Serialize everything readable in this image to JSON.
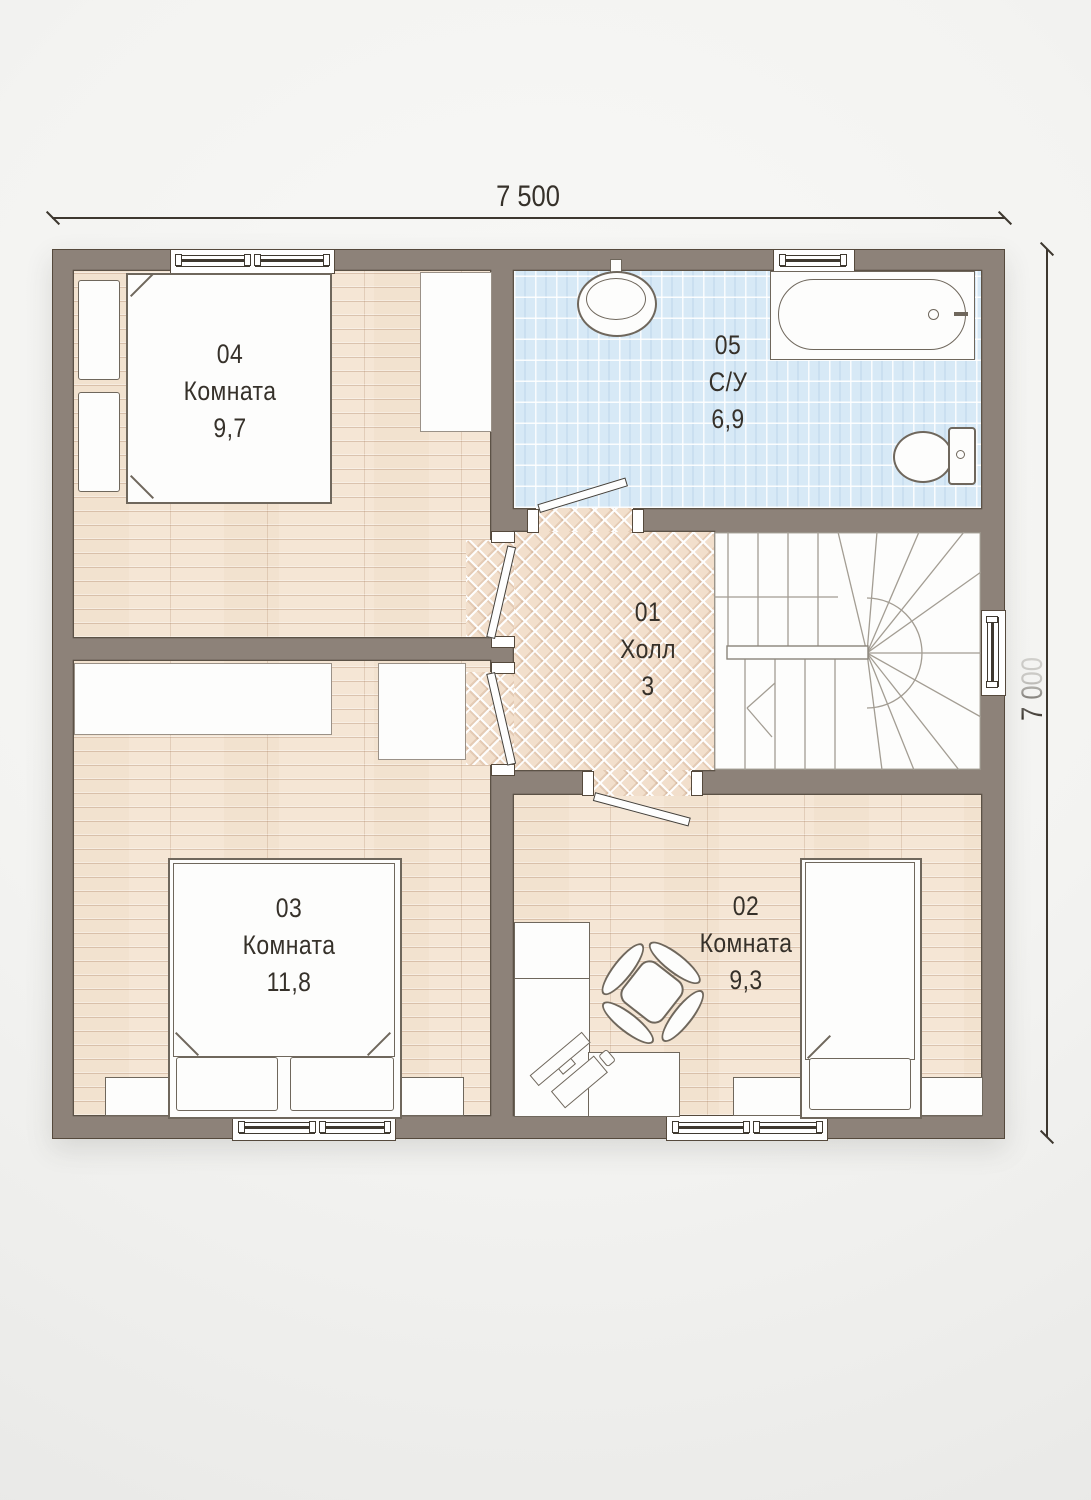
{
  "dimensions": {
    "width_label": "7 500",
    "height_label": "7 000"
  },
  "rooms": {
    "hall": {
      "number": "01",
      "name": "Холл",
      "area": "3"
    },
    "room2": {
      "number": "02",
      "name": "Комната",
      "area": "9,3"
    },
    "room3": {
      "number": "03",
      "name": "Комната",
      "area": "11,8"
    },
    "room4": {
      "number": "04",
      "name": "Комната",
      "area": "9,7"
    },
    "bathroom": {
      "number": "05",
      "name": "С/У",
      "area": "6,9"
    }
  },
  "colors": {
    "wall": "#8d8279",
    "wall_outline": "#55493c",
    "wood_floor": "#f5e6d5",
    "parquet_floor": "#f2dfcc",
    "tile_floor": "#d7e9f6",
    "furniture_outline": "#6f675c",
    "background": "#f1f1ef",
    "text": "#36312a"
  }
}
